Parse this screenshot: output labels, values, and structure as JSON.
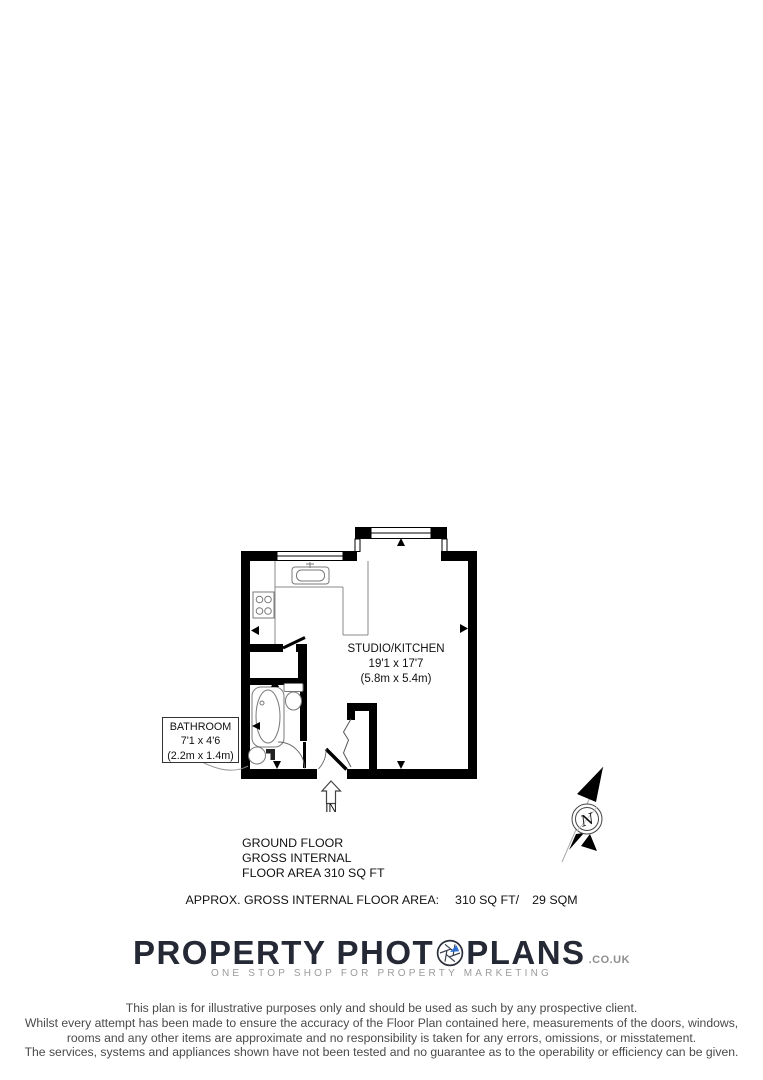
{
  "plan": {
    "rooms": {
      "studio": {
        "name": "STUDIO/KITCHEN",
        "imperial": "19'1 x 17'7",
        "metric": "(5.8m x 5.4m)"
      },
      "bathroom": {
        "name": "BATHROOM",
        "imperial": "7'1 x 4'6",
        "metric": "(2.2m x 1.4m)"
      }
    },
    "entrance_label": "IN",
    "compass_label": "N"
  },
  "summary": {
    "floor_title": "GROUND FLOOR",
    "gross_line": "GROSS INTERNAL",
    "area_line": "FLOOR AREA 310 SQ FT",
    "approx_label": "APPROX. GROSS INTERNAL FLOOR AREA:",
    "approx_imperial": "310 SQ FT/",
    "approx_metric": "29 SQM"
  },
  "branding": {
    "logo_part1": "PROPERTY PHOT",
    "logo_part2": "PLANS",
    "logo_suffix": ".CO.UK",
    "tagline": "ONE STOP SHOP FOR PROPERTY MARKETING",
    "logo_color": "#252935",
    "accent_blue": "#2e6fd4"
  },
  "disclaimer": {
    "line1": "This plan is for illustrative purposes only and should be used as such by any prospective client.",
    "line2": "Whilst every attempt has been made to ensure the accuracy of the Floor Plan contained here, measurements of the doors, windows,",
    "line3": "rooms and any other items are approximate and no responsibility is taken for any errors, omissions, or misstatement.",
    "line4": "The services, systems and appliances shown have not been tested and no guarantee as to the operability or efficiency can be given."
  }
}
